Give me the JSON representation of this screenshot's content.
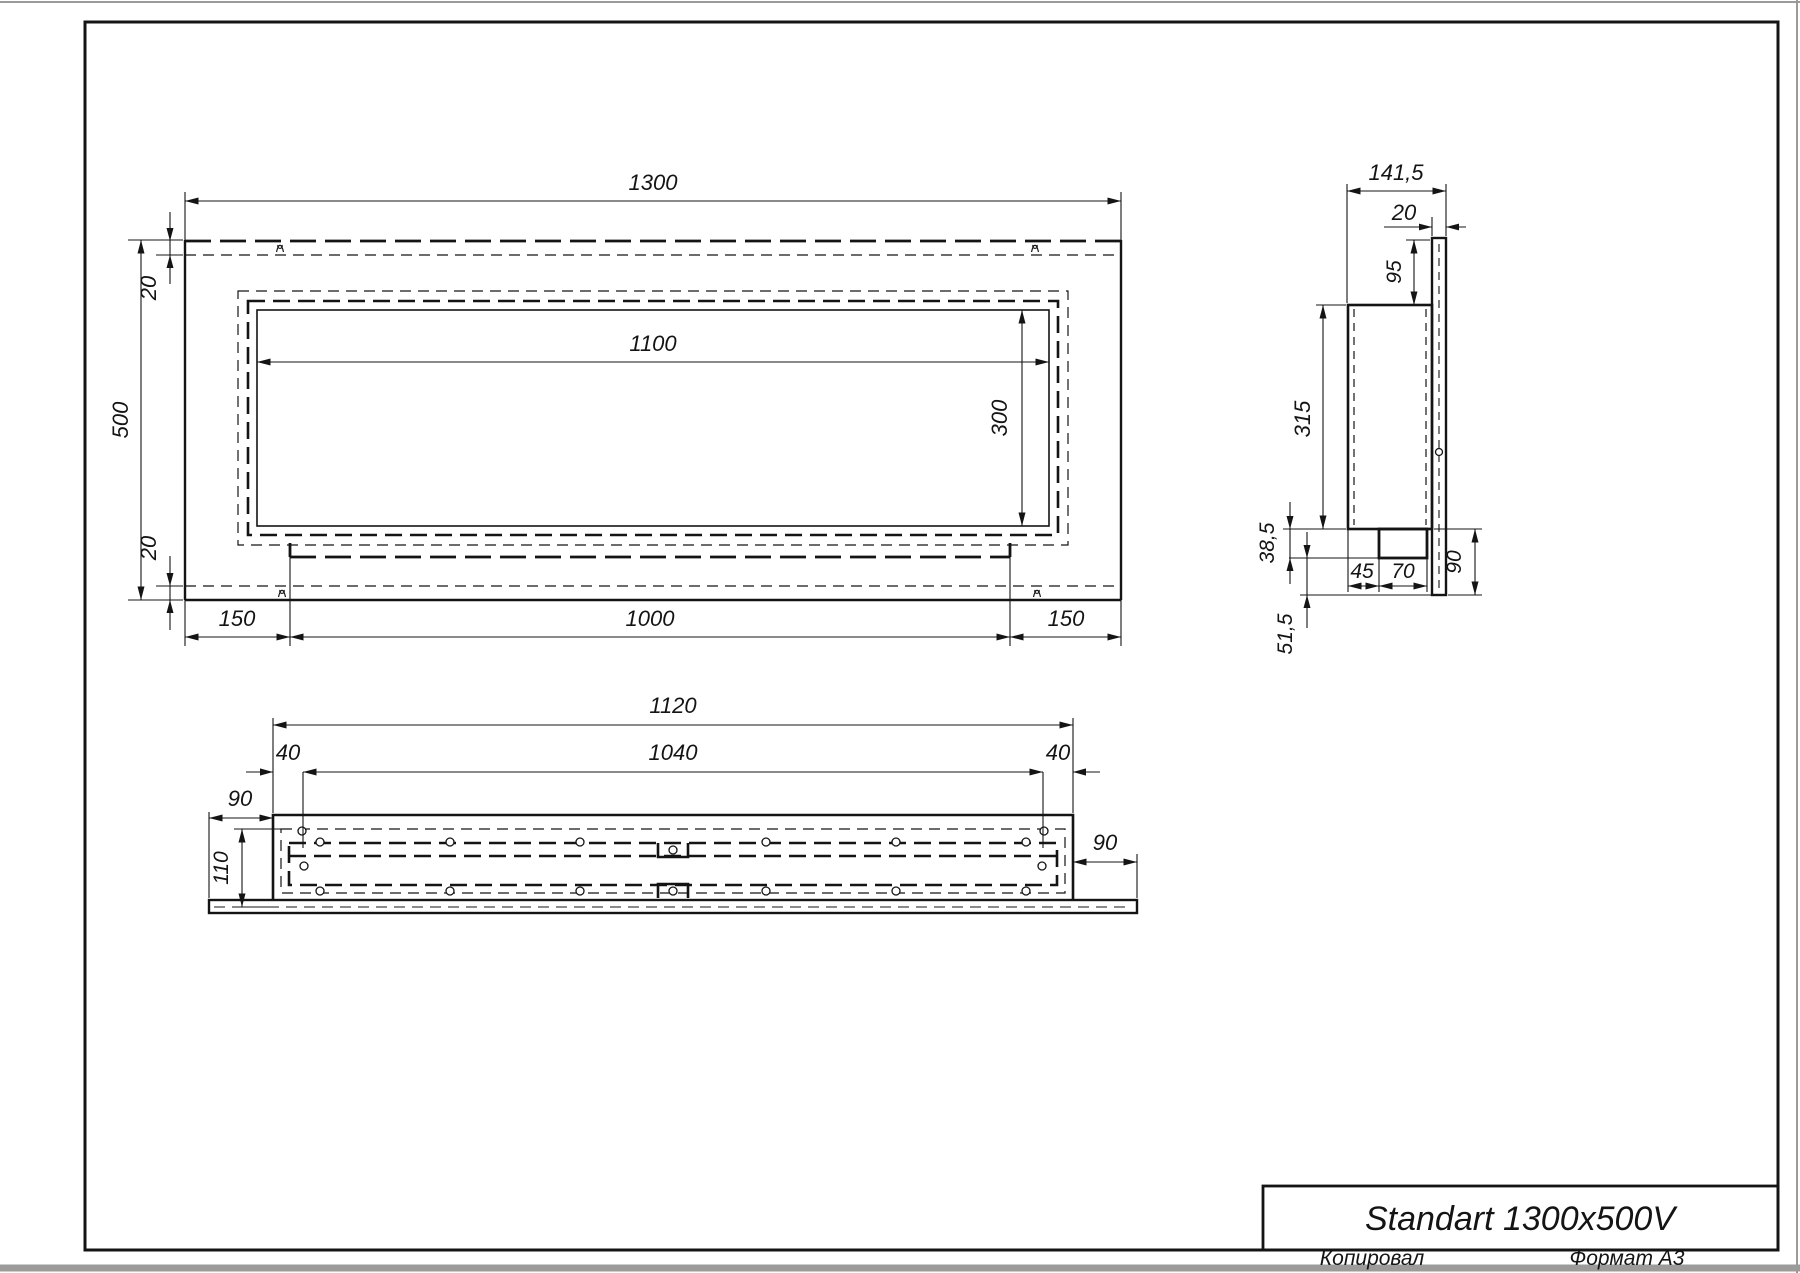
{
  "colors": {
    "line": "#141414"
  },
  "front": {
    "total_width": "1300",
    "total_height": "500",
    "top_gap": "20",
    "bottom_gap": "20",
    "opening_width": "1100",
    "opening_height": "300",
    "left_margin": "150",
    "tab_width": "1000",
    "right_margin": "150"
  },
  "side": {
    "total_depth": "141,5",
    "panel_thickness": "20",
    "top_drop": "95",
    "body_height": "315",
    "step_down": "38,5",
    "bottom_drop": "51,5",
    "foot_inset": "45",
    "foot_width": "70",
    "flange_height": "90"
  },
  "bottom": {
    "total_width": "1120",
    "inner_width": "1040",
    "left_end": "40",
    "right_end": "40",
    "left_flange": "90",
    "body_depth": "110",
    "right_flange": "90"
  },
  "title_block": {
    "model": "Standart 1300x500V"
  },
  "footer": {
    "copied_by": "Копировал",
    "format": "Формат А3"
  }
}
